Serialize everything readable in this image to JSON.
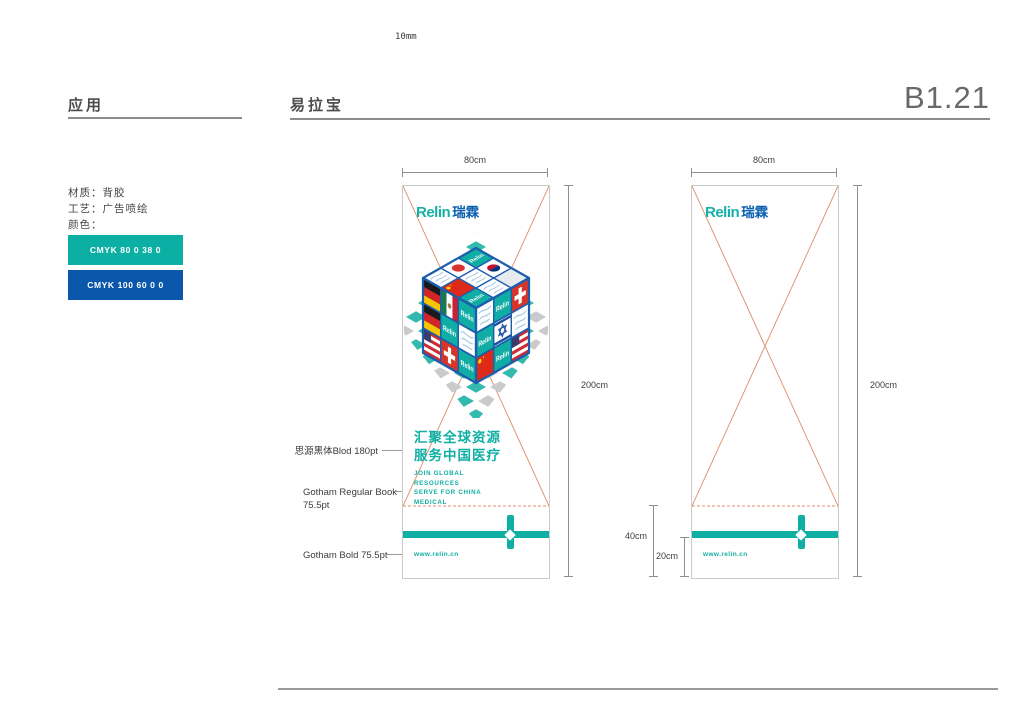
{
  "palette": {
    "teal": "#10AFA4",
    "blue": "#0B57AC",
    "logo_teal": "#14B1A7",
    "logo_blue": "#0C60B0",
    "pattern_teal": "#33B9AE",
    "pattern_gray": "#C9CACB",
    "cube_frame": "#1D5DAD",
    "cutline": "#DB8F66",
    "dim_line": "#8F8F8F",
    "rule_gray": "#8C8C8C"
  },
  "header": {
    "ruler_label": "10mm",
    "section_application": "应用",
    "section_item": "易拉宝",
    "page_code": "B1.21"
  },
  "specs": {
    "lines": [
      "材质：背胶",
      "工艺：广告喷绘",
      "颜色："
    ]
  },
  "colors": [
    {
      "label": "CMYK 80 0 38 0",
      "hex": "#0CAFA3"
    },
    {
      "label": "CMYK 100 60 0 0",
      "hex": "#0B57AC"
    }
  ],
  "banner": {
    "logo_en": "Relin",
    "logo_cn": "瑞霖",
    "headline_line1": "汇聚全球资源",
    "headline_line2": "服务中国医疗",
    "sub_lines": [
      "JOIN GLOBAL",
      "RESOURCES",
      "SERVE FOR CHINA",
      "MEDICAL"
    ],
    "website": "www.relin.cn"
  },
  "dimensions": {
    "width": "80cm",
    "height": "200cm",
    "base": "40cm",
    "footer": "20cm"
  },
  "annotations": {
    "headline_font": "思源黑体Blod 180pt",
    "body_font_line1": "Gotham Regular Book",
    "body_font_line2": "75.5pt",
    "site_font": "Gotham Bold 75.5pt"
  }
}
